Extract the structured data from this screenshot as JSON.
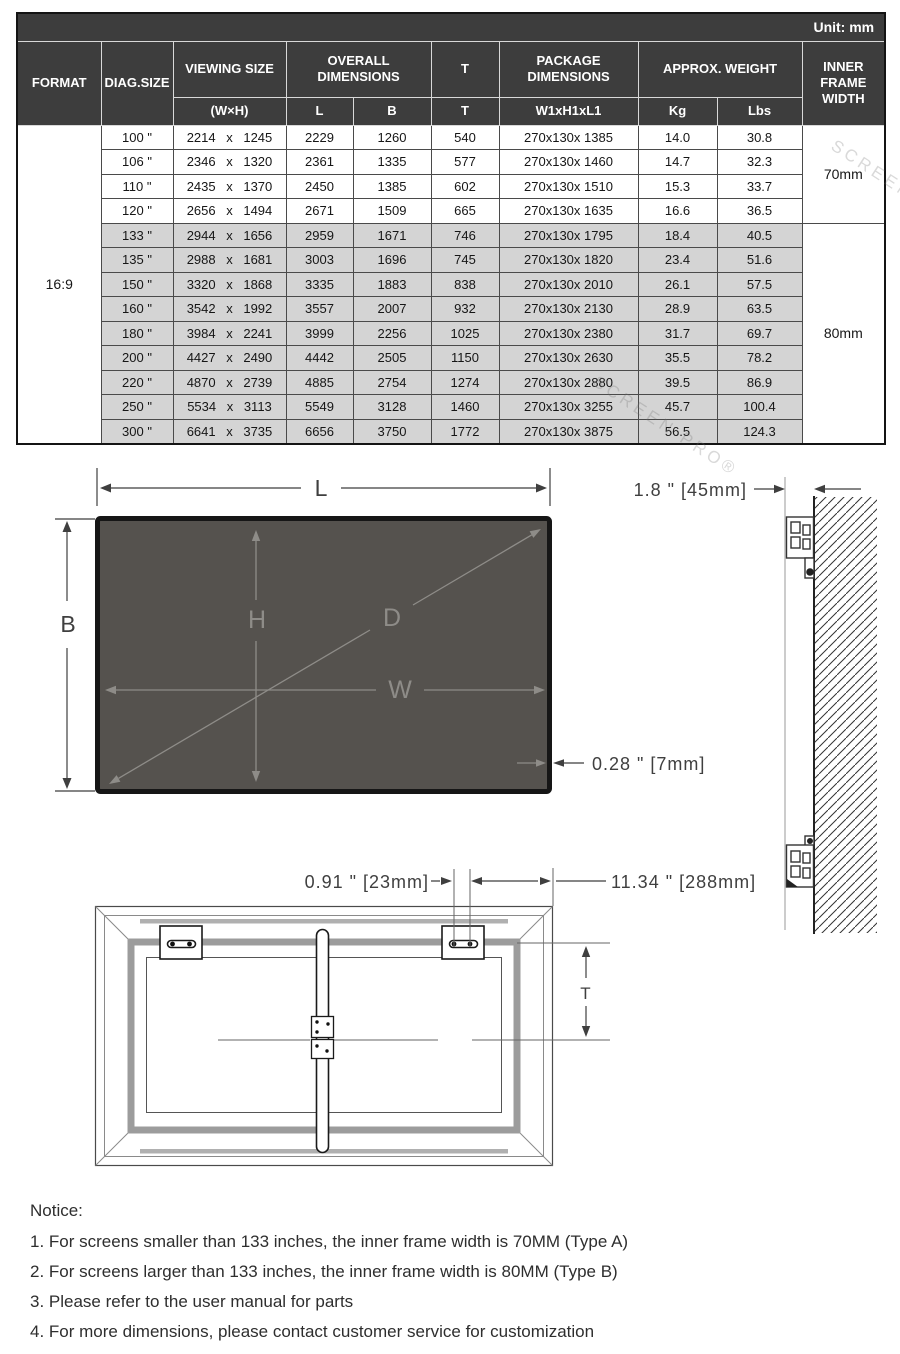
{
  "table": {
    "unit_label": "Unit: mm",
    "headers": {
      "format": "FORMAT",
      "diag_size": "DIAG.SIZE",
      "viewing_size": "VIEWING SIZE",
      "viewing_size_sub": "(W×H)",
      "overall_dimensions": "OVERALL DIMENSIONS",
      "l": "L",
      "b": "B",
      "t_group": "T",
      "t_sub": "T",
      "package_dimensions": "PACKAGE DIMENSIONS",
      "package_sub": "W1xH1xL1",
      "approx_weight": "APPROX. WEIGHT",
      "kg": "Kg",
      "lbs": "Lbs",
      "inner_frame_width": "INNER FRAME WIDTH"
    },
    "format_value": "16:9",
    "inner_frame_70": "70mm",
    "inner_frame_80": "80mm",
    "rows": [
      {
        "diag": "100 \"",
        "viewing": "2214 x 1245",
        "l": "2229",
        "b": "1260",
        "t": "540",
        "package": "270x130x 1385",
        "kg": "14.0",
        "lbs": "30.8",
        "shade": false
      },
      {
        "diag": "106 \"",
        "viewing": "2346 x 1320",
        "l": "2361",
        "b": "1335",
        "t": "577",
        "package": "270x130x 1460",
        "kg": "14.7",
        "lbs": "32.3",
        "shade": false
      },
      {
        "diag": "110 \"",
        "viewing": "2435 x 1370",
        "l": "2450",
        "b": "1385",
        "t": "602",
        "package": "270x130x 1510",
        "kg": "15.3",
        "lbs": "33.7",
        "shade": false
      },
      {
        "diag": "120 \"",
        "viewing": "2656 x 1494",
        "l": "2671",
        "b": "1509",
        "t": "665",
        "package": "270x130x 1635",
        "kg": "16.6",
        "lbs": "36.5",
        "shade": false
      },
      {
        "diag": "133 \"",
        "viewing": "2944 x 1656",
        "l": "2959",
        "b": "1671",
        "t": "746",
        "package": "270x130x 1795",
        "kg": "18.4",
        "lbs": "40.5",
        "shade": true
      },
      {
        "diag": "135 \"",
        "viewing": "2988 x 1681",
        "l": "3003",
        "b": "1696",
        "t": "745",
        "package": "270x130x 1820",
        "kg": "23.4",
        "lbs": "51.6",
        "shade": true
      },
      {
        "diag": "150 \"",
        "viewing": "3320 x 1868",
        "l": "3335",
        "b": "1883",
        "t": "838",
        "package": "270x130x 2010",
        "kg": "26.1",
        "lbs": "57.5",
        "shade": true
      },
      {
        "diag": "160 \"",
        "viewing": "3542 x 1992",
        "l": "3557",
        "b": "2007",
        "t": "932",
        "package": "270x130x 2130",
        "kg": "28.9",
        "lbs": "63.5",
        "shade": true
      },
      {
        "diag": "180 \"",
        "viewing": "3984 x 2241",
        "l": "3999",
        "b": "2256",
        "t": "1025",
        "package": "270x130x 2380",
        "kg": "31.7",
        "lbs": "69.7",
        "shade": true
      },
      {
        "diag": "200 \"",
        "viewing": "4427 x 2490",
        "l": "4442",
        "b": "2505",
        "t": "1150",
        "package": "270x130x 2630",
        "kg": "35.5",
        "lbs": "78.2",
        "shade": true
      },
      {
        "diag": "220 \"",
        "viewing": "4870 x 2739",
        "l": "4885",
        "b": "2754",
        "t": "1274",
        "package": "270x130x 2880",
        "kg": "39.5",
        "lbs": "86.9",
        "shade": true
      },
      {
        "diag": "250 \"",
        "viewing": "5534 x 3113",
        "l": "5549",
        "b": "3128",
        "t": "1460",
        "package": "270x130x 3255",
        "kg": "45.7",
        "lbs": "100.4",
        "shade": true
      },
      {
        "diag": "300 \"",
        "viewing": "6641 x 3735",
        "l": "6656",
        "b": "3750",
        "t": "1772",
        "package": "270x130x 3875",
        "kg": "56.5",
        "lbs": "124.3",
        "shade": true
      }
    ]
  },
  "front_view": {
    "length_label": "L",
    "outer_height_label": "B",
    "inner_height_label": "H",
    "diagonal_label": "D",
    "inner_width_label": "W",
    "thickness_label": "0.28 \" [7mm]"
  },
  "side_view": {
    "depth_label": "1.8 \" [45mm]"
  },
  "back_view": {
    "bracket_offset_label": "0.91 \" [23mm]",
    "bracket_spacing_label": "11.34 \" [288mm]",
    "t_label": "T"
  },
  "watermark": "SCREEN PRO®",
  "colors": {
    "header_bg": "#3D3D3D",
    "row_shade": "#D4D4D4",
    "screen_fill": "#55524E"
  },
  "notice": {
    "title": "Notice:",
    "items": [
      "1. For screens smaller than 133 inches, the inner frame width is 70MM (Type A)",
      "2. For screens larger than 133 inches, the inner frame width is 80MM (Type B)",
      "3. Please refer to the user manual for parts",
      "4. For more dimensions, please contact customer service for customization"
    ]
  }
}
